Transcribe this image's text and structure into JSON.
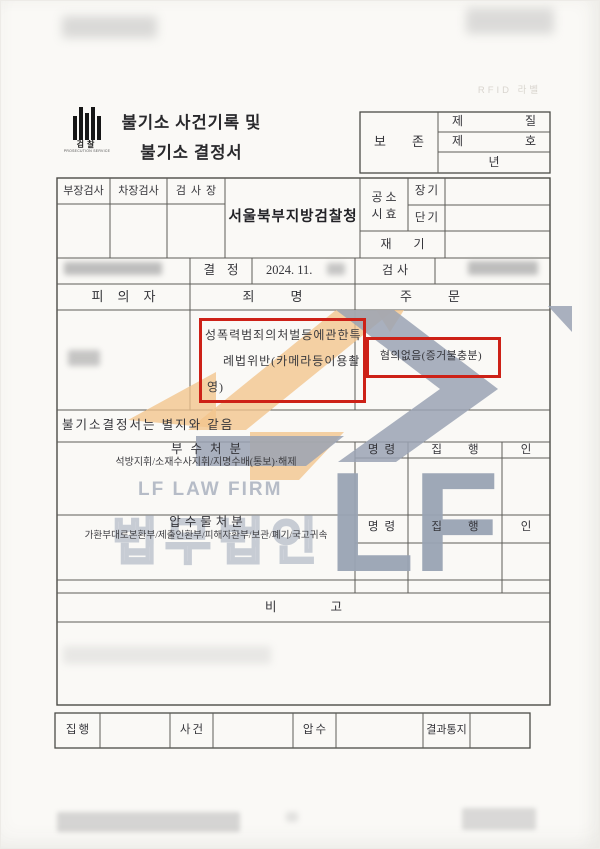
{
  "colors": {
    "accent_red": "#cd2117",
    "watermark_orange": "#f2c48c",
    "watermark_gray": "#9aa3b4"
  },
  "scan": {
    "rfid_label": "RFID 라벨"
  },
  "emblem": {
    "ko": "검찰",
    "en": "PROSECUTION SERVICE"
  },
  "title": {
    "line1": "불기소 사건기록 및",
    "line2": "불기소 결정서"
  },
  "preservation": {
    "label": "보존",
    "r1l": "제",
    "r1r": "질",
    "r2l": "제",
    "r2r": "호",
    "r3": "년"
  },
  "staff": {
    "dept": "부장검사",
    "deputy": "차장검사",
    "chief": "검사장",
    "office": "서울북부지방검찰청"
  },
  "limitation": {
    "label_l1": "공소",
    "label_l2": "시효",
    "long": "장기",
    "short": "단기",
    "reopen": "재기"
  },
  "decision": {
    "label": "결정",
    "date": "2024. 11.",
    "prosecutor_label": "검사"
  },
  "columns": {
    "suspect": "피의자",
    "charge": "죄명",
    "order": "주문"
  },
  "charge": {
    "lines": [
      "성폭력범죄의처벌등에관한특",
      "례법위반(카메라등이용촬",
      "영)"
    ]
  },
  "order": {
    "text": "혐의없음(증거불충분)"
  },
  "note": "불기소결정서는 별지와 같음",
  "accessory": {
    "title": "부수처분",
    "subtitle": "석방지휘/소재수사지휘/지명수배(통보)·해제",
    "command": "명령",
    "execute": "집행",
    "seal": "인"
  },
  "seized": {
    "title": "압수물처분",
    "subtitle": "가환부대로본환부/제출인환부/피해자환부/보관/폐기/국고귀속",
    "command": "명령",
    "execute": "집행",
    "seal": "인"
  },
  "remarks": {
    "label": "비고"
  },
  "footer": {
    "execution": "집행",
    "case": "사건",
    "seizure": "압수",
    "notice": "결과통지"
  },
  "watermark": {
    "firm_en": "LF LAW FIRM",
    "firm_ko": "법무법인",
    "initials": "LF"
  }
}
